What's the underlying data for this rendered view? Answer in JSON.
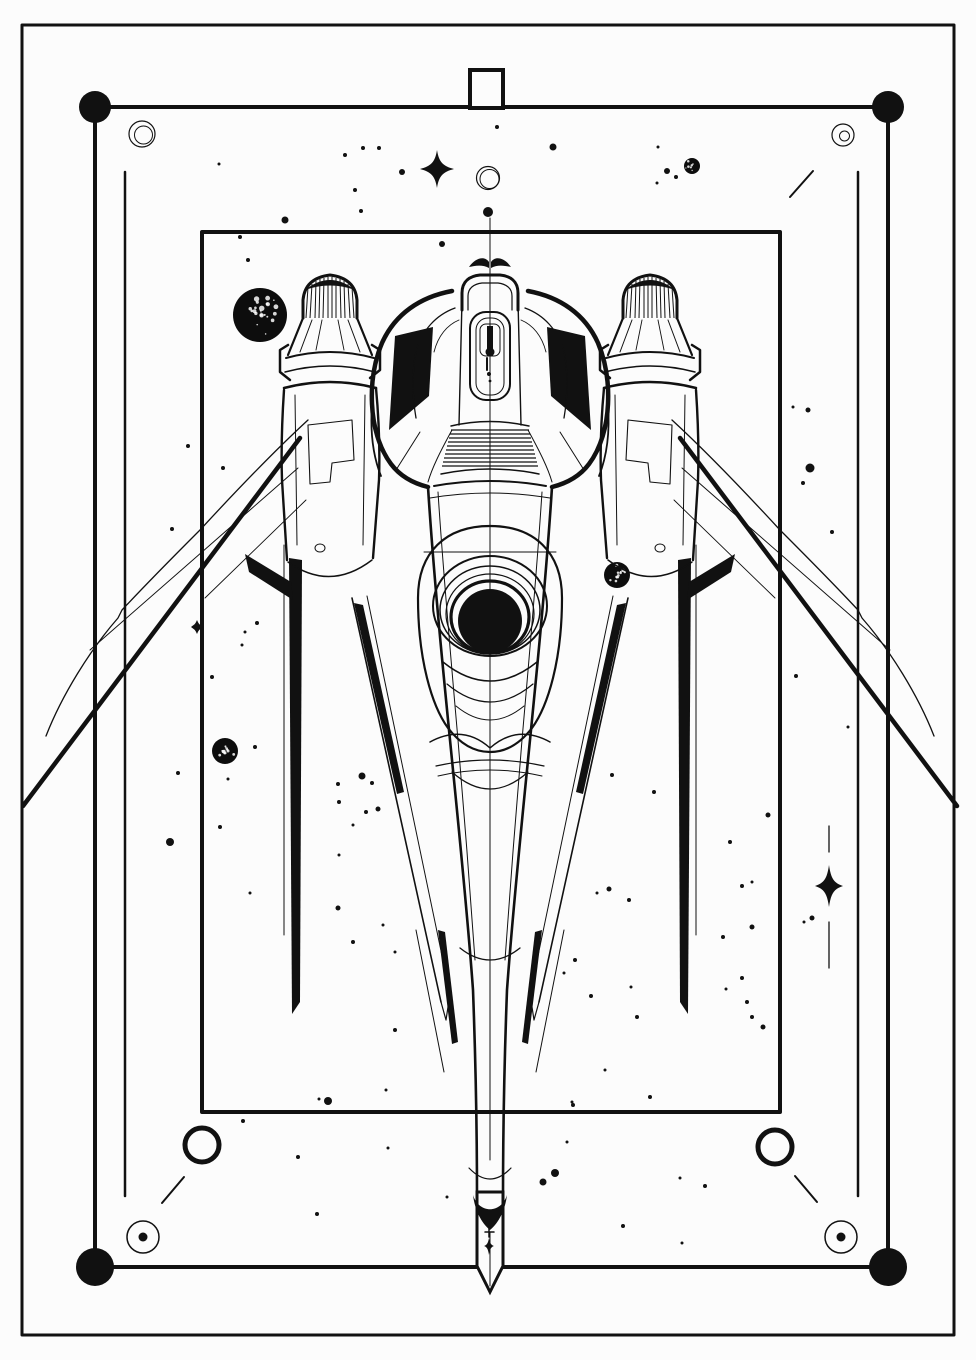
{
  "artwork": {
    "title": "Spaceship line-art coloring page",
    "type": "black and white illustration, top view starfighter inside decorative frames",
    "accessible_label": "Line drawing of a symmetrical spaceship with twin striped booster pods, swept wings, a large round engine eye and a pen-nib tail, surrounded by stars, dots, speckled planets and rectangular frames"
  },
  "palette": {
    "ink": "#111111",
    "paper": "#fcfcfc"
  },
  "scene": {
    "dots": [
      [
        219,
        164,
        1.5
      ],
      [
        240,
        237,
        2
      ],
      [
        248,
        260,
        2
      ],
      [
        285,
        220,
        3.5
      ],
      [
        345,
        155,
        2
      ],
      [
        363,
        148,
        2
      ],
      [
        379,
        148,
        2
      ],
      [
        402,
        172,
        3
      ],
      [
        355,
        190,
        2
      ],
      [
        361,
        211,
        2
      ],
      [
        442,
        244,
        3
      ],
      [
        497,
        127,
        2
      ],
      [
        553,
        147,
        3.5
      ],
      [
        488,
        212,
        5
      ],
      [
        658,
        147,
        1.5
      ],
      [
        667,
        171,
        3
      ],
      [
        676,
        177,
        2
      ],
      [
        657,
        183,
        1.5
      ],
      [
        808,
        410,
        2.5
      ],
      [
        793,
        407,
        1.5
      ],
      [
        810,
        468,
        4.5
      ],
      [
        803,
        483,
        2
      ],
      [
        832,
        532,
        2
      ],
      [
        796,
        676,
        2
      ],
      [
        848,
        727,
        1.5
      ],
      [
        172,
        529,
        2
      ],
      [
        188,
        446,
        2
      ],
      [
        223,
        468,
        2
      ],
      [
        257,
        623,
        2
      ],
      [
        245,
        632,
        1.5
      ],
      [
        242,
        645,
        1.5
      ],
      [
        212,
        677,
        2
      ],
      [
        255,
        747,
        2
      ],
      [
        178,
        773,
        2
      ],
      [
        170,
        842,
        4
      ],
      [
        228,
        779,
        1.5
      ],
      [
        338,
        784,
        2
      ],
      [
        220,
        827,
        2
      ],
      [
        339,
        855,
        1.5
      ],
      [
        250,
        893,
        1.5
      ],
      [
        362,
        776,
        3.5
      ],
      [
        372,
        783,
        2
      ],
      [
        339,
        802,
        2
      ],
      [
        378,
        809,
        2.5
      ],
      [
        366,
        812,
        2
      ],
      [
        353,
        825,
        1.5
      ],
      [
        338,
        908,
        2.5
      ],
      [
        353,
        942,
        2
      ],
      [
        395,
        952,
        1.5
      ],
      [
        612,
        775,
        2
      ],
      [
        654,
        792,
        2
      ],
      [
        768,
        815,
        2.5
      ],
      [
        730,
        842,
        2
      ],
      [
        609,
        889,
        2.5
      ],
      [
        597,
        893,
        1.5
      ],
      [
        629,
        900,
        2
      ],
      [
        742,
        886,
        2
      ],
      [
        752,
        882,
        1.5
      ],
      [
        752,
        927,
        2.5
      ],
      [
        723,
        937,
        2
      ],
      [
        575,
        960,
        2
      ],
      [
        564,
        973,
        1.5
      ],
      [
        591,
        996,
        2
      ],
      [
        631,
        987,
        1.5
      ],
      [
        637,
        1017,
        2
      ],
      [
        742,
        978,
        2
      ],
      [
        726,
        989,
        1.5
      ],
      [
        747,
        1002,
        2
      ],
      [
        752,
        1017,
        2
      ],
      [
        763,
        1027,
        2.5
      ],
      [
        605,
        1070,
        1.5
      ],
      [
        650,
        1097,
        2
      ],
      [
        572,
        1102,
        1.5
      ],
      [
        812,
        918,
        2.5
      ],
      [
        804,
        922,
        1.5
      ],
      [
        383,
        925,
        1.5
      ],
      [
        395,
        1030,
        2
      ],
      [
        386,
        1090,
        1.5
      ],
      [
        573,
        1105,
        2
      ],
      [
        388,
        1148,
        1.5
      ],
      [
        567,
        1142,
        1.5
      ],
      [
        543,
        1182,
        3.5
      ],
      [
        555,
        1173,
        4
      ],
      [
        447,
        1197,
        1.5
      ],
      [
        243,
        1121,
        2
      ],
      [
        328,
        1101,
        4
      ],
      [
        319,
        1099,
        1.5
      ],
      [
        298,
        1157,
        2
      ],
      [
        680,
        1178,
        1.5
      ],
      [
        705,
        1186,
        2
      ],
      [
        682,
        1243,
        1.5
      ],
      [
        317,
        1214,
        2
      ],
      [
        623,
        1226,
        2
      ]
    ],
    "stars": [
      {
        "cx": 437,
        "cy": 169,
        "v": 19,
        "h": 17
      },
      {
        "cx": 829,
        "cy": 886,
        "v": 21,
        "h": 14
      },
      {
        "cx": 197,
        "cy": 627,
        "v": 7,
        "h": 6
      }
    ],
    "star_needles": [
      [
        829,
        826,
        829,
        852
      ],
      [
        829,
        922,
        829,
        968
      ]
    ],
    "planets": [
      {
        "cx": 260,
        "cy": 315,
        "r": 27
      },
      {
        "cx": 225,
        "cy": 751,
        "r": 13
      },
      {
        "cx": 617,
        "cy": 575,
        "r": 13
      },
      {
        "cx": 692,
        "cy": 166,
        "r": 8
      }
    ],
    "bold_rings": [
      [
        202,
        1145,
        17,
        5
      ],
      [
        775,
        1147,
        17,
        5
      ]
    ],
    "dotted_circles": [
      [
        143,
        1237,
        16,
        4.5
      ],
      [
        841,
        1237,
        16,
        4.5
      ]
    ],
    "ticks": [
      [
        162,
        1203,
        184,
        1177
      ],
      [
        795,
        1176,
        817,
        1202
      ],
      [
        790,
        197,
        813,
        171
      ]
    ],
    "sketch_circles": [
      {
        "cx": 142,
        "cy": 134,
        "r": 13,
        "inner": 9
      },
      {
        "cx": 843,
        "cy": 135,
        "r": 11,
        "inner": 5
      },
      {
        "cx": 488,
        "cy": 178,
        "r": 11.5,
        "inner": 9.5
      }
    ]
  }
}
